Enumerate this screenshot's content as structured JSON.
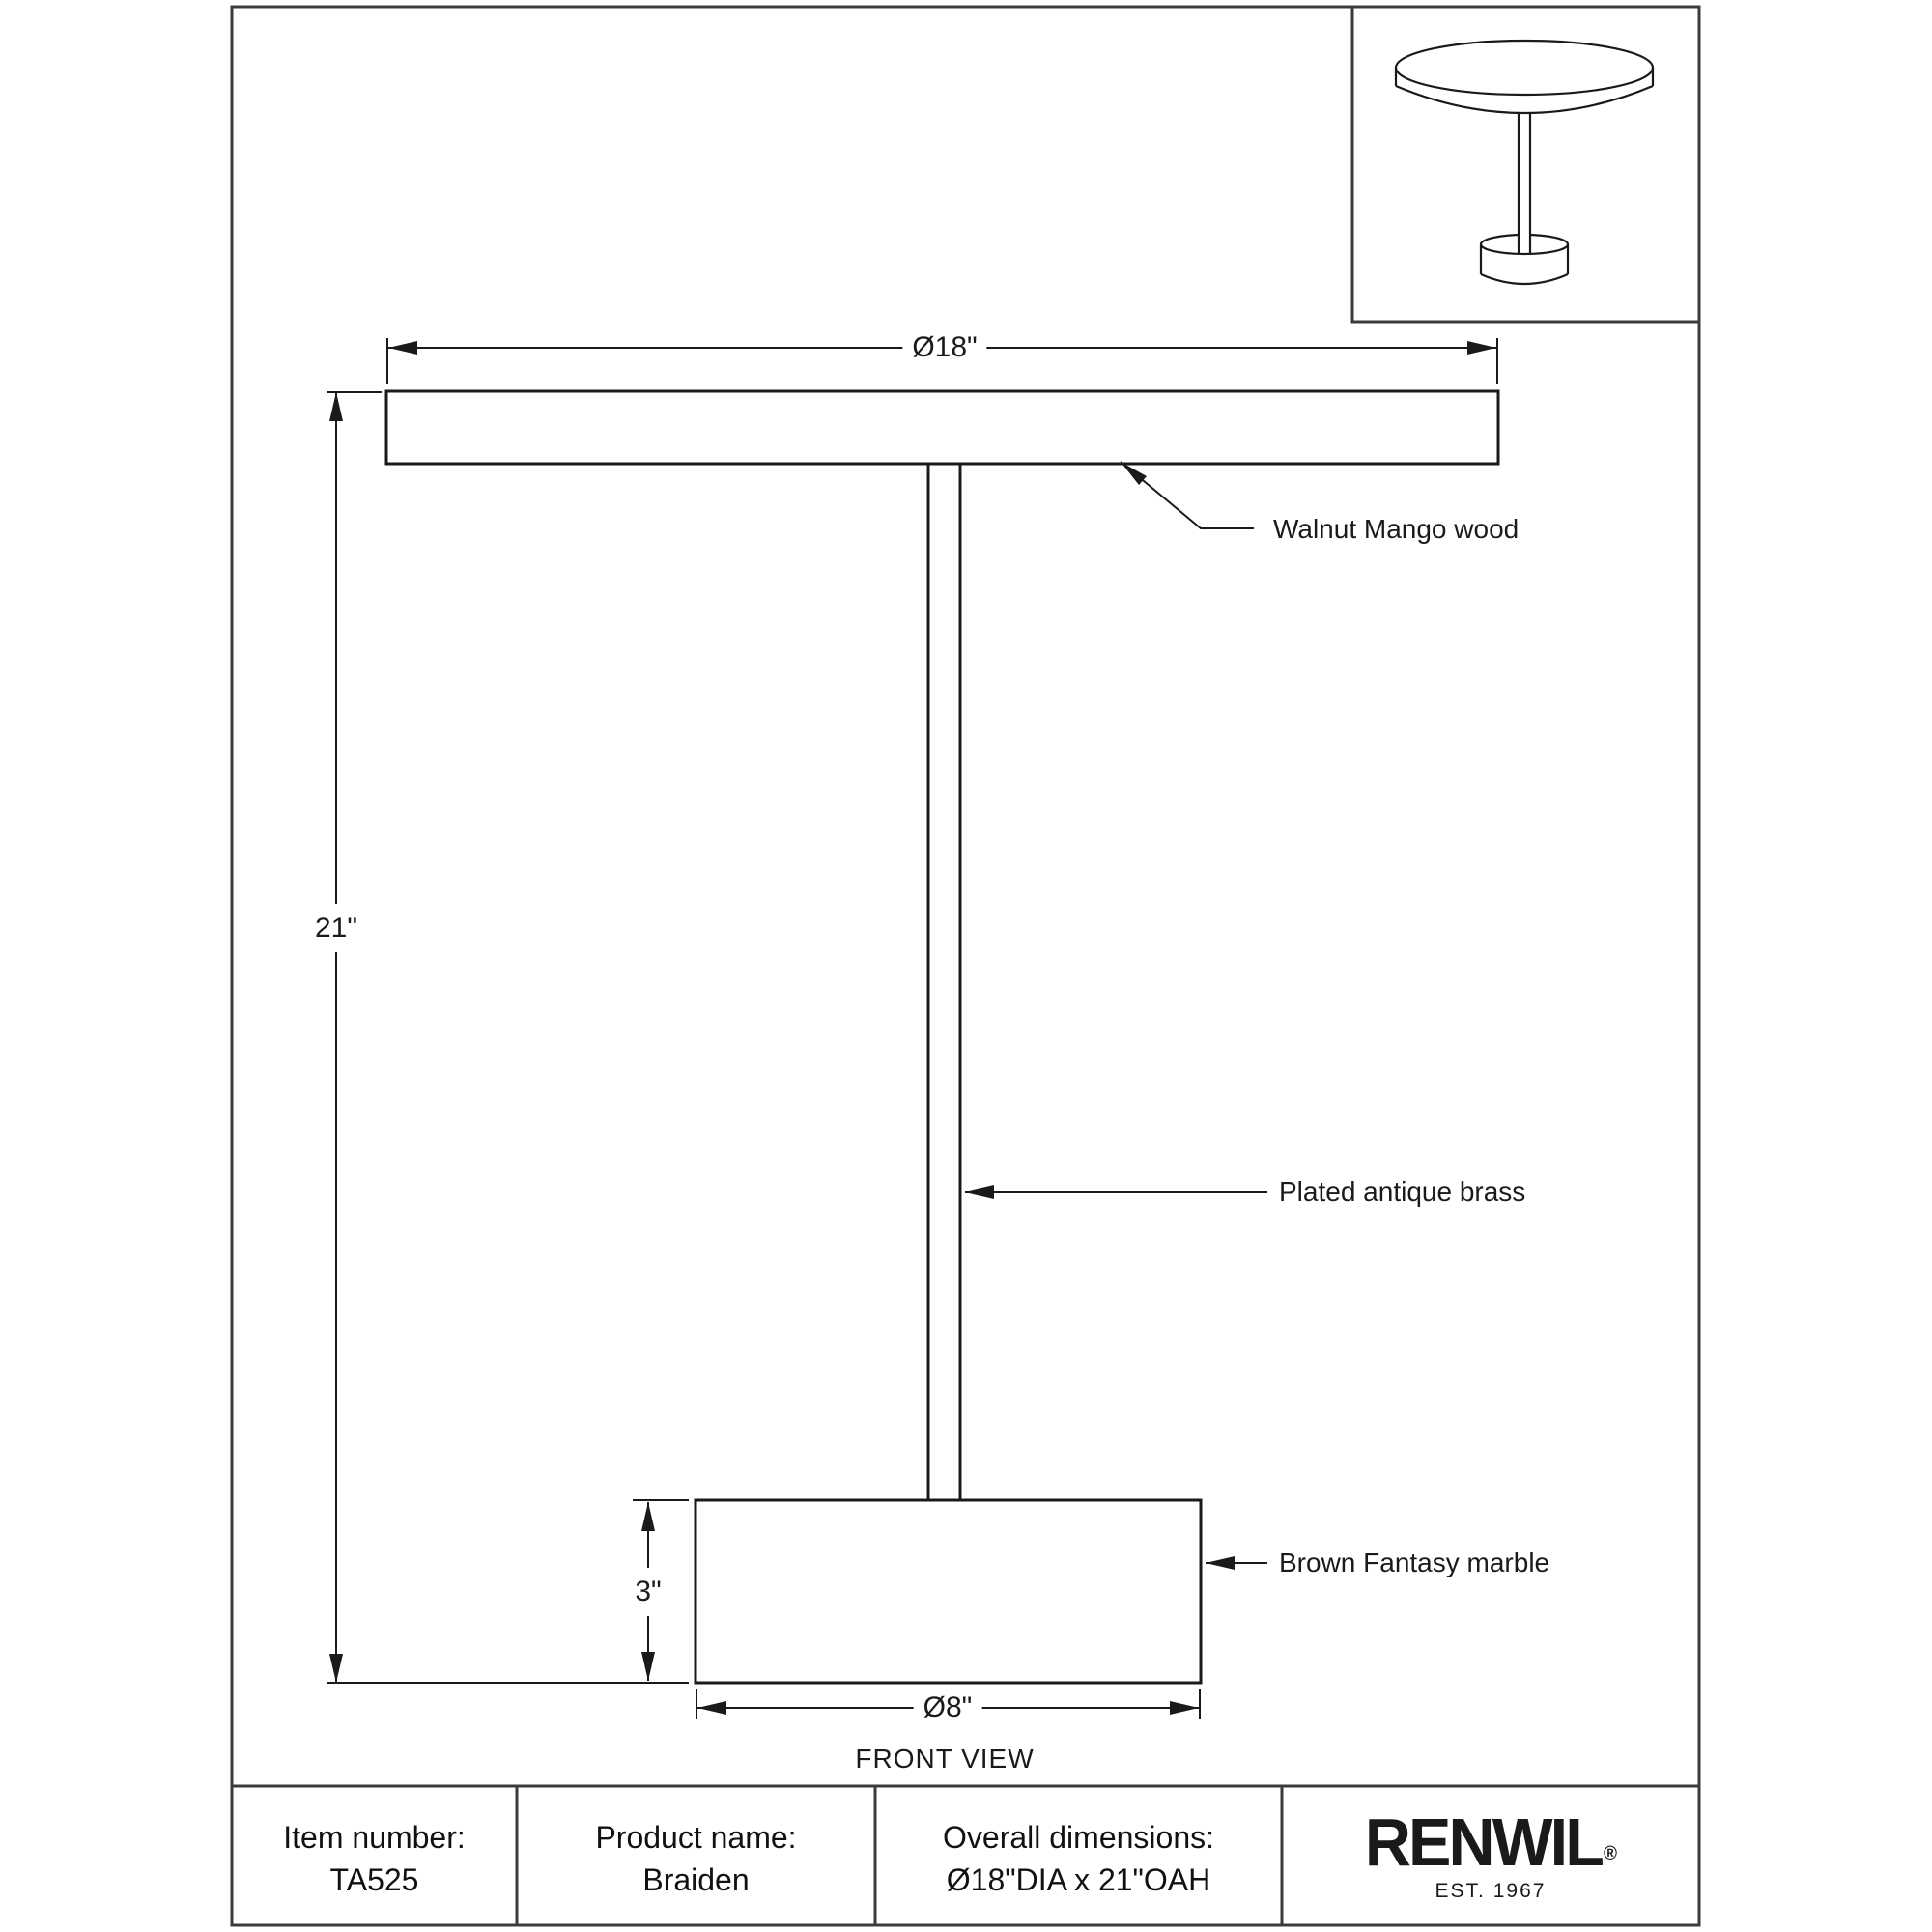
{
  "document": {
    "view_label": "FRONT VIEW"
  },
  "dimensions": {
    "top_diameter": "Ø18\"",
    "overall_height": "21\"",
    "base_height": "3\"",
    "base_diameter": "Ø8\""
  },
  "callouts": {
    "tabletop_material": "Walnut Mango wood",
    "stem_material": "Plated antique brass",
    "base_material": "Brown Fantasy marble"
  },
  "info_table": {
    "cells": [
      {
        "label": "Item number:",
        "value": "TA525"
      },
      {
        "label": "Product name:",
        "value": "Braiden"
      },
      {
        "label": "Overall dimensions:",
        "value": "Ø18\"DIA x 21\"OAH"
      }
    ]
  },
  "brand": {
    "logo_text": "RENWIL",
    "registered_mark": "®",
    "established_text": "EST. 1967"
  },
  "colors": {
    "line": "#1a1a1a",
    "frame": "#3b3b3b",
    "background": "#ffffff"
  }
}
